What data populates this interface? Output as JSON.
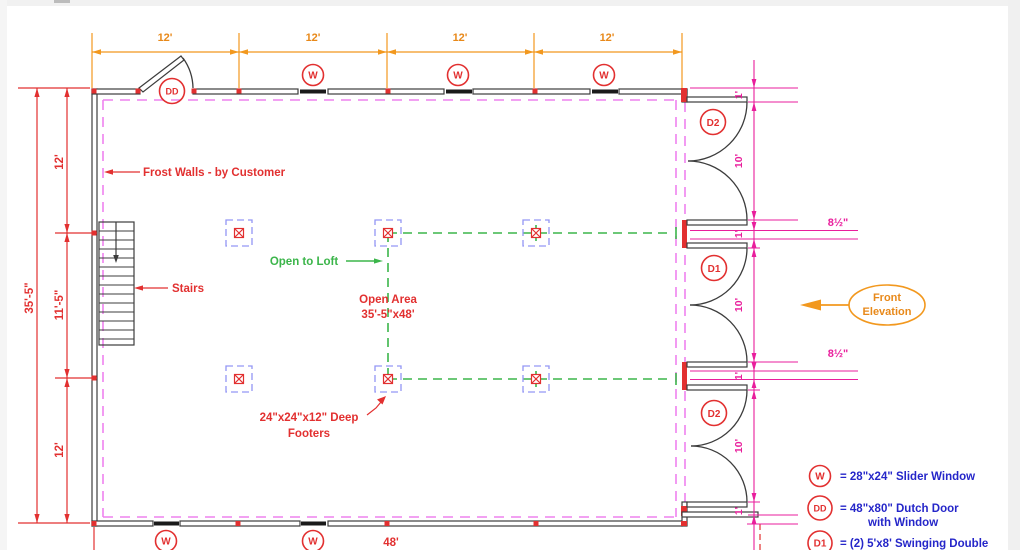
{
  "plan": {
    "dimensions": {
      "top_segments": [
        "12'",
        "12'",
        "12'",
        "12'"
      ],
      "left_total": "35'-5\"",
      "left_segments": [
        "12'",
        "11'-5\"",
        "12'"
      ],
      "bottom_total": "48'",
      "right_one_foot": "1'",
      "right_ten_feet": "10'",
      "post_width": "8½\""
    },
    "labels": {
      "frost_walls": "Frost Walls - by Customer",
      "stairs": "Stairs",
      "open_to_loft": "Open to Loft",
      "open_area_line1": "Open Area",
      "open_area_line2": "35'-5\"x48'",
      "footers_line1": "24\"x24\"x12\" Deep",
      "footers_line2": "Footers",
      "front_elevation_line1": "Front",
      "front_elevation_line2": "Elevation"
    },
    "symbols": {
      "window": "W",
      "dutch_door": "DD",
      "door1": "D1",
      "door2": "D2"
    },
    "legend": {
      "window_text": "= 28\"x24\" Slider Window",
      "dutch_door_text_line1": "= 48\"x80\" Dutch Door",
      "dutch_door_text_line2": "with Window",
      "door1_text": "= (2) 5'x8' Swinging Double"
    },
    "colors": {
      "dimension_orange": "#E8891A",
      "annotation_red": "#E23030",
      "dimension_magenta": "#E91E9C",
      "frost_wall_violet": "#EE82EE",
      "loft_green": "#3BB54A",
      "footer_blue": "#9396F5",
      "legend_blue": "#2526C9",
      "wall_dark": "#3C3C3C"
    }
  }
}
